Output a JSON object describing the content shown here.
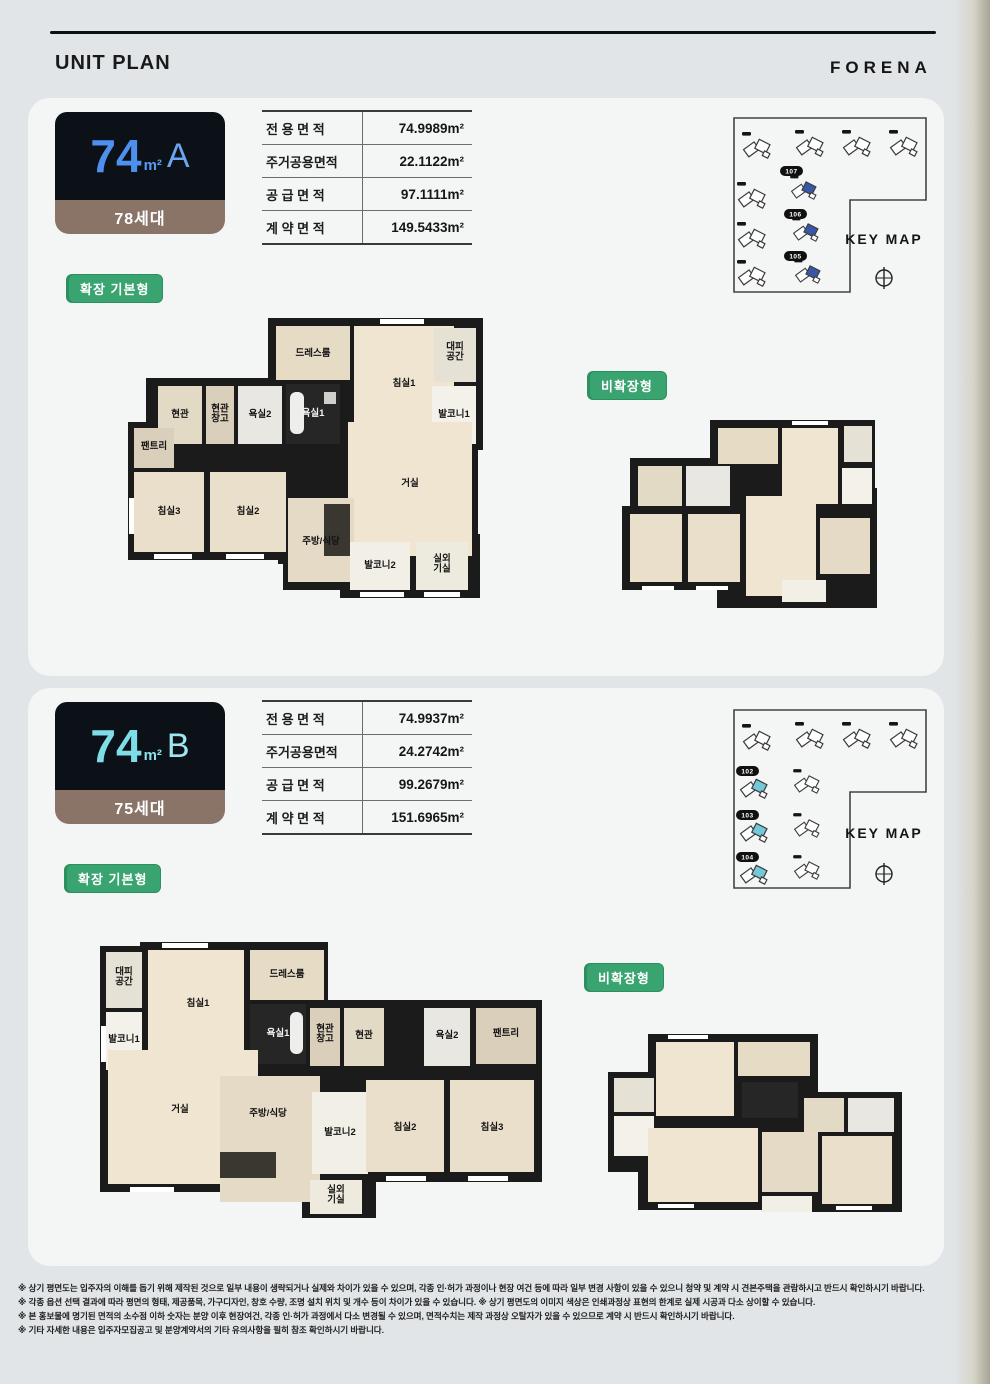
{
  "header": {
    "title": "UNIT PLAN",
    "brand": "FORENA"
  },
  "sections": [
    {
      "id": "74A",
      "badge": {
        "size": "74",
        "unit": "m²",
        "type": "A",
        "households": "78세대"
      },
      "table": {
        "rows": [
          {
            "label": "전 용 면 적",
            "value": "74.9989m²"
          },
          {
            "label": "주거공용면적",
            "value": "22.1122m²"
          },
          {
            "label": "공 급 면 적",
            "value": "97.1111m²"
          },
          {
            "label": "계 약 면 적",
            "value": "149.5433m²"
          }
        ]
      },
      "keymap": {
        "label": "KEY MAP",
        "buildings": [
          "107",
          "106",
          "105"
        ],
        "highlight_color": "#3a57a7"
      },
      "plan_expanded_label": "확장 기본형",
      "plan_basic_label": "비확장형",
      "rooms": {
        "entry": "현관",
        "entry_storage": "현관창고",
        "bath2": "욕실2",
        "bath1": "욕실1",
        "dress": "드레스룸",
        "bed1": "침실1",
        "shelter": "대피공간",
        "balcony1": "발코니1",
        "pantry": "팬트리",
        "bed3": "침실3",
        "bed2": "침실2",
        "living": "거실",
        "kitchen": "주방/식당",
        "balcony2": "발코니2",
        "ac": "실외기실"
      }
    },
    {
      "id": "74B",
      "badge": {
        "size": "74",
        "unit": "m²",
        "type": "B",
        "households": "75세대"
      },
      "table": {
        "rows": [
          {
            "label": "전 용 면 적",
            "value": "74.9937m²"
          },
          {
            "label": "주거공용면적",
            "value": "24.2742m²"
          },
          {
            "label": "공 급 면 적",
            "value": "99.2679m²"
          },
          {
            "label": "계 약 면 적",
            "value": "151.6965m²"
          }
        ]
      },
      "keymap": {
        "label": "KEY MAP",
        "buildings": [
          "102",
          "103",
          "104"
        ],
        "highlight_color": "#74c9d8"
      },
      "plan_expanded_label": "확장 기본형",
      "plan_basic_label": "비확장형",
      "rooms": {
        "entry": "현관",
        "entry_storage": "현관창고",
        "bath2": "욕실2",
        "bath1": "욕실1",
        "dress": "드레스룸",
        "bed1": "침실1",
        "shelter": "대피공간",
        "balcony1": "발코니1",
        "pantry": "팬트리",
        "bed3": "침실3",
        "bed2": "침실2",
        "living": "거실",
        "kitchen": "주방/식당",
        "balcony2": "발코니2",
        "ac": "실외기실"
      }
    }
  ],
  "footer": {
    "notes": [
      "※ 상기 평면도는 입주자의 이해를 돕기 위해 제작된 것으로 일부 내용이 생략되거나 실제와 차이가 있을 수 있으며, 각종 인·허가 과정이나 현장 여건 등에 따라 일부 변경 사항이 있을 수 있으니 청약 및 계약 시 견본주택을 관람하시고 반드시 확인하시기 바랍니다.",
      "※ 각종 옵션 선택 결과에 따라 평면의 형태, 제공품목, 가구디자인, 창호 수량, 조명 설치 위치 및 개수 등이 차이가 있을 수 있습니다. ※ 상기 평면도의 이미지 색상은 인쇄과정상 표현의 한계로 실제 시공과 다소 상이할 수 있습니다.",
      "※ 본 홍보물에 명기된 면적의 소수점 이하 숫자는 분양 이후 현장여건, 각종 인·허가 과정에서 다소 변경될 수 있으며, 면적수치는 제작 과정상 오탈자가 있을 수 있으므로 계약 시 반드시 확인하시기 바랍니다.",
      "※ 기타 자세한 내용은 입주자모집공고 및 분양계약서의 기타 유의사항을 필히 참조 확인하시기 바랍니다."
    ]
  },
  "colors": {
    "badge_num_a": "#4d90ee",
    "badge_num_b": "#7edee7",
    "badge_bg": "#0c1118",
    "households_bar": "#8a7468",
    "tag_green": "#3aa471",
    "keymap_highlight_a": "#3a57a7",
    "keymap_highlight_b": "#74c9d8"
  }
}
